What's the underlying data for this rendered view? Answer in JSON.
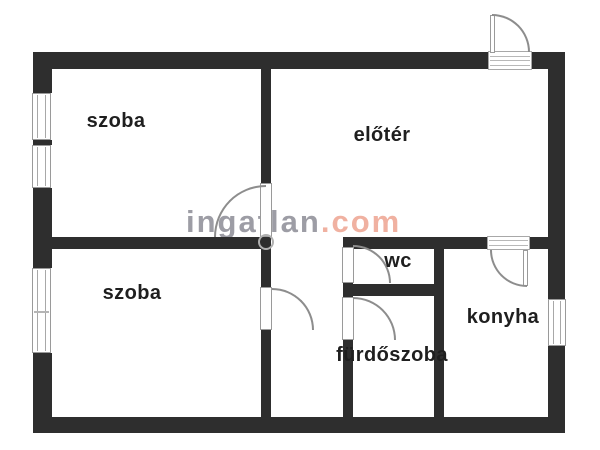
{
  "floorplan": {
    "rooms": [
      {
        "id": "szoba-top",
        "label": "szoba"
      },
      {
        "id": "eloter",
        "label": "előtér"
      },
      {
        "id": "szoba-bottom",
        "label": "szoba"
      },
      {
        "id": "wc",
        "label": "wc"
      },
      {
        "id": "konyha",
        "label": "konyha"
      },
      {
        "id": "furdoszoba",
        "label": "fürdőszoba"
      }
    ],
    "colors": {
      "wall": "#2e2e2e",
      "room_label": "#1f1f1f",
      "fixture_outline": "#9a9a9a",
      "background": "#ffffff",
      "watermark_gray": "#9d9da5",
      "watermark_accent": "#f0b1a1"
    }
  },
  "watermark": {
    "name": "ingatlan",
    "tld": ".com"
  }
}
